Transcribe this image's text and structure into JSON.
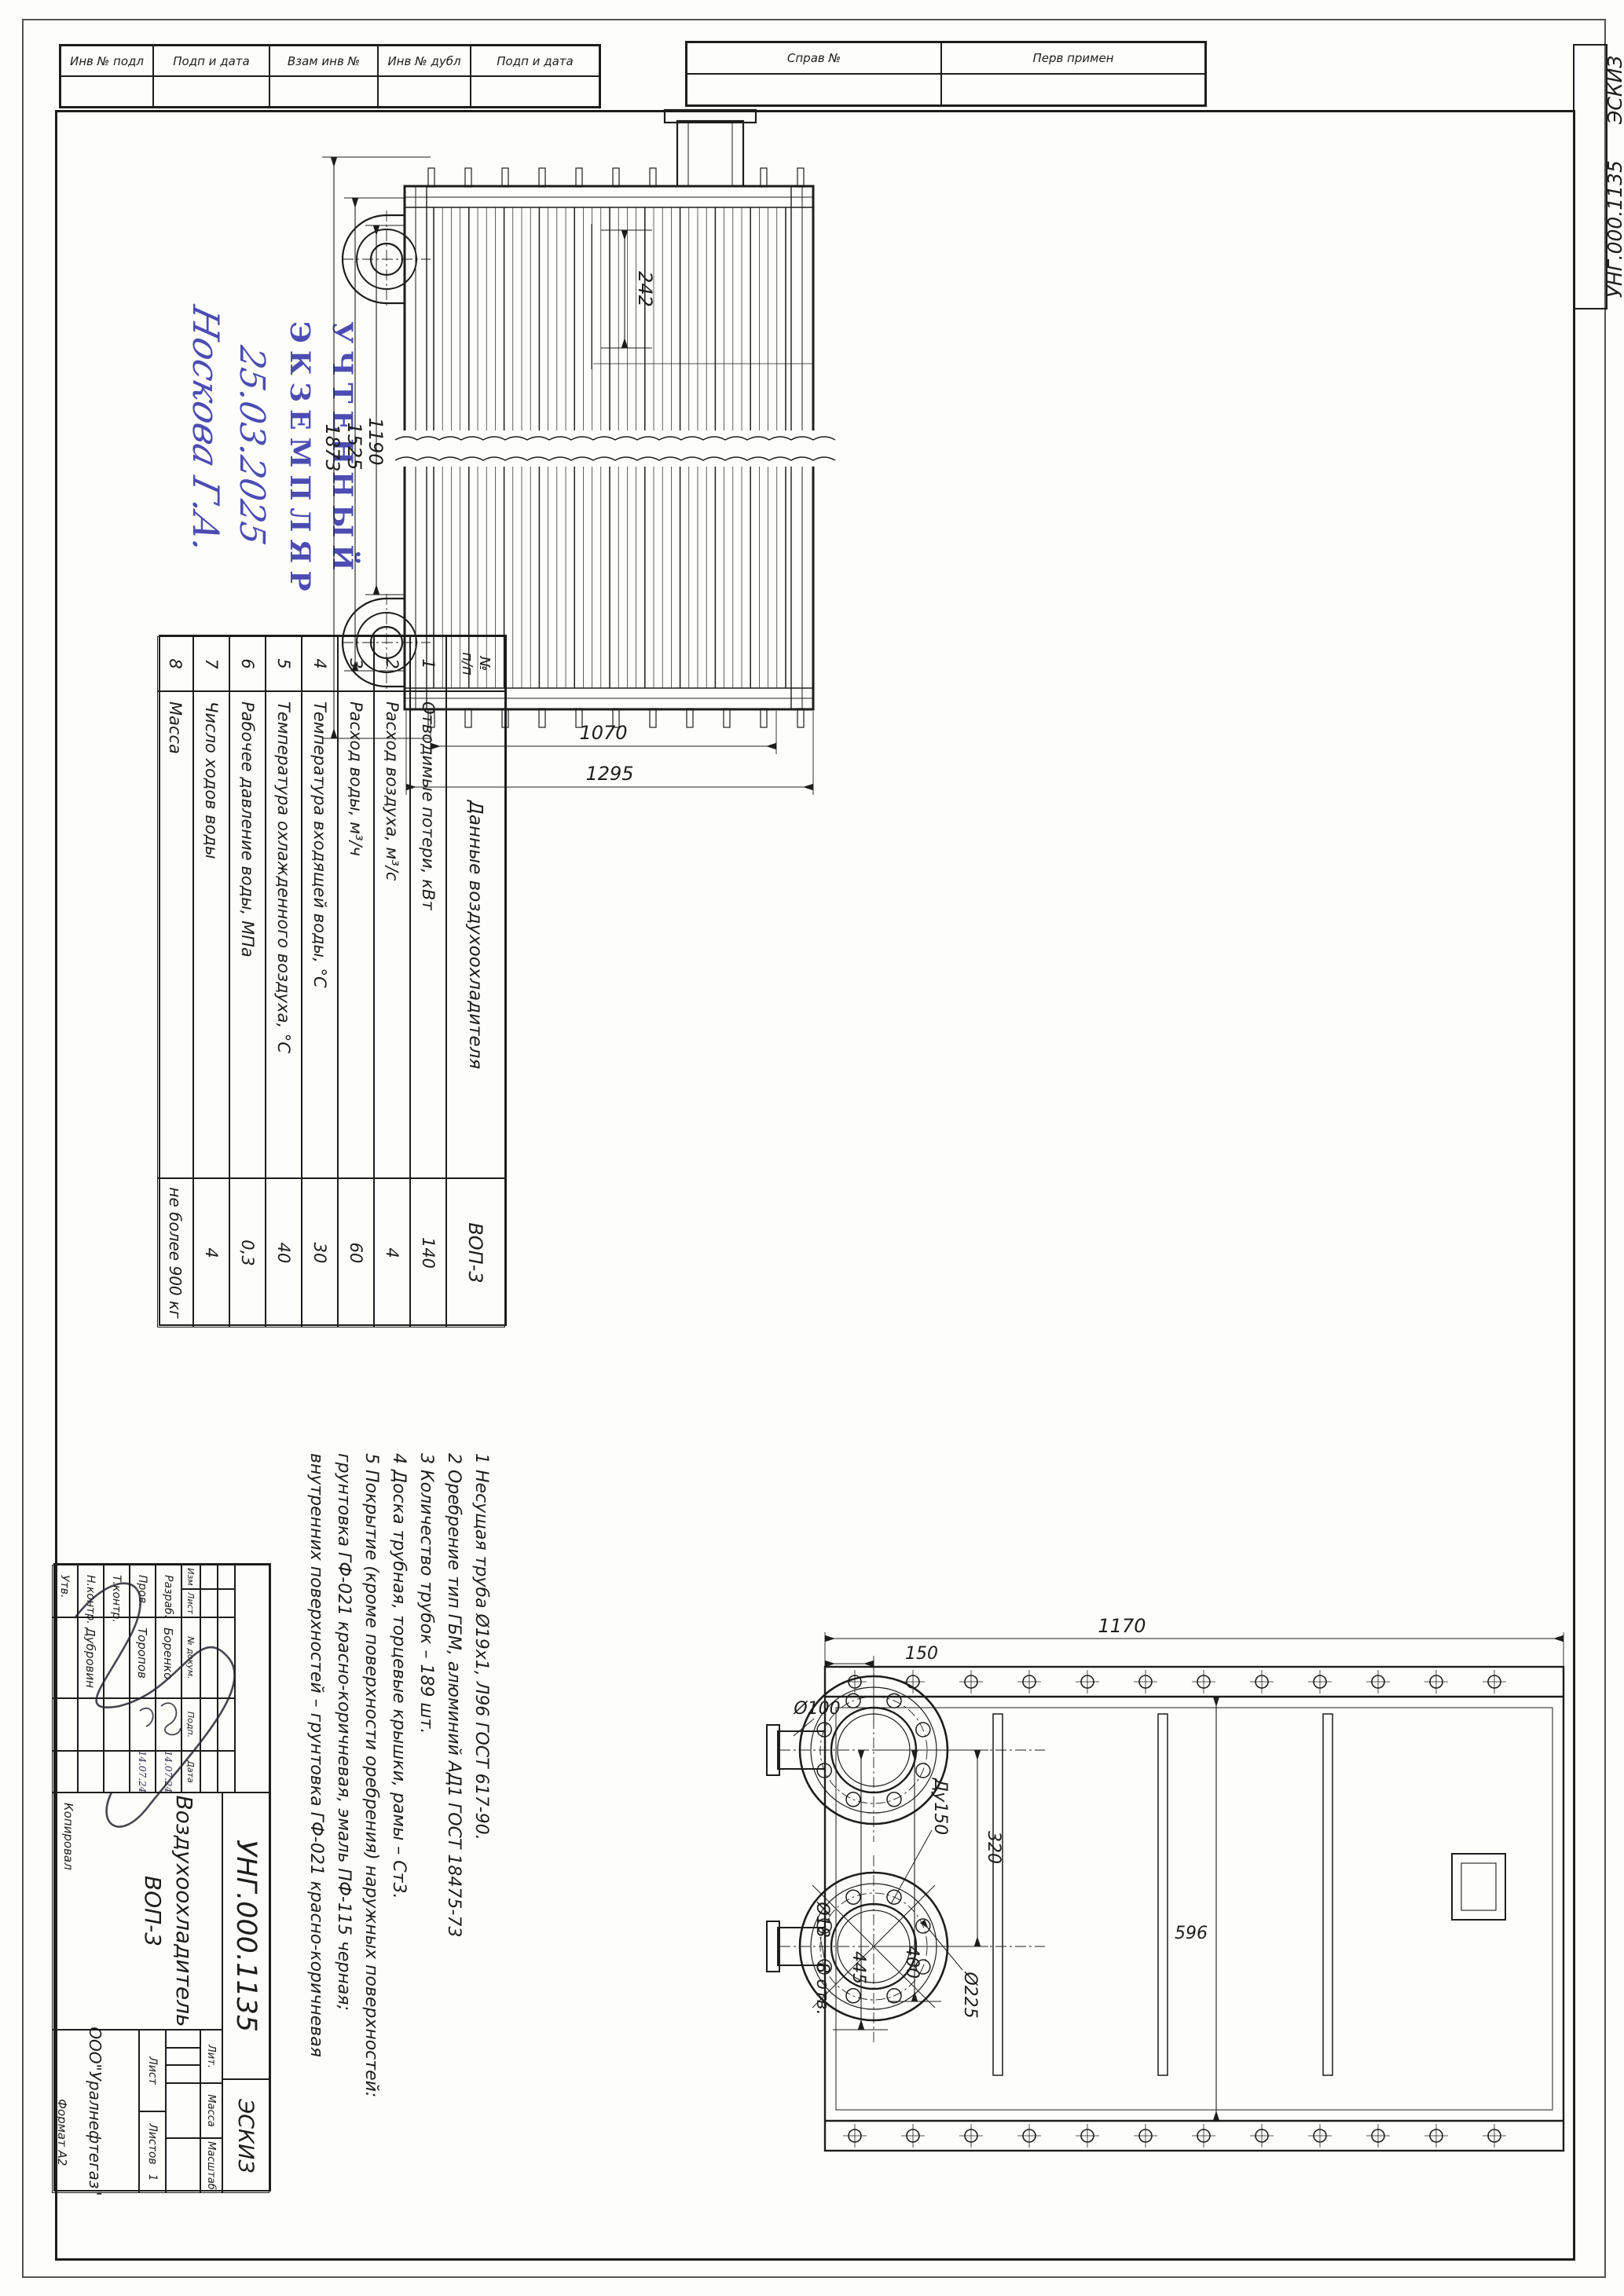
{
  "colors": {
    "ink": "#1d1d1b",
    "stamp_blue": "#3f3fae",
    "paper": "#fdfdfa"
  },
  "top_strips": {
    "left": [
      "Инв № подл",
      "Подп и дата",
      "Взам инв №",
      "Инв № дубл",
      "Подп и дата"
    ],
    "right": [
      "Справ №",
      "Перв примен"
    ]
  },
  "corner": {
    "code": "УНГ.000.1135",
    "type": "ЭСКИЗ"
  },
  "stamp": {
    "line1": "УЧТЕННЫЙ",
    "line2": "ЭКЗЕМПЛЯР",
    "date": "25.03.2025",
    "signer": "Носкова Г.А."
  },
  "spec_table": {
    "col_num_1": "№",
    "col_num_2": "п/п",
    "col_name": "Данные воздухоохладителя",
    "col_value": "ВОП-3",
    "rows": [
      {
        "n": "1",
        "name": "Отводимые потери, кВт",
        "value": "140"
      },
      {
        "n": "2",
        "name": "Расход воздуха, м³/с",
        "value": "4"
      },
      {
        "n": "3",
        "name": "Расход воды, м³/ч",
        "value": "60"
      },
      {
        "n": "4",
        "name": "Температура входящей воды, °С",
        "value": "30"
      },
      {
        "n": "5",
        "name": "Температура охлажденного воздуха, °С",
        "value": "40"
      },
      {
        "n": "6",
        "name": "Рабочее давление воды, МПа",
        "value": "0,3"
      },
      {
        "n": "7",
        "name": "Число ходов воды",
        "value": "4"
      },
      {
        "n": "8",
        "name": "Масса",
        "value": "не более 900 кг"
      }
    ]
  },
  "notes": [
    "1 Несущая труба Ø19х1,  Л96 ГОСТ 617-90.",
    "2 Оребрение тип ГБМ,  алюминий АД1 ГОСТ 18475-73",
    "3 Количество трубок – 189 шт.",
    "4 Доска трубная, торцевые крышки, рамы – Ст3.",
    "5 Покрытие (кроме поверхности оребрения) наружных поверхностей:",
    "грунтовка  ГФ-021  красно-коричневая,  эмаль  ПФ-115  черная;",
    "внутренних поверхностей – грунтовка ГФ-021 красно-коричневая"
  ],
  "main_view": {
    "dim_242": "242",
    "dim_1873": "1873",
    "dim_1525": "1525",
    "dim_1190": "1190",
    "dim_1070": "1070",
    "dim_1295": "1295"
  },
  "bottom_view": {
    "dim_1170": "1170",
    "dim_150": "150",
    "dim_100": "Ø100",
    "dim_445": "445",
    "dim_400": "400",
    "dim_320": "320",
    "dim_596": "596",
    "dim_225": "Ø225",
    "dim_18": "Ø18",
    "dim_8otv": "8 отв.",
    "dim_du150": "Ду150"
  },
  "title_block": {
    "designation": "УНГ.000.1135",
    "doc_type": "ЭСКИЗ",
    "name_line1": "Воздухоохладитель",
    "name_line2": "ВОП-3",
    "company": "ООО\"Уралнефтегаз\"",
    "cols": [
      "Изм",
      "Лист",
      "№ докум.",
      "Подп.",
      "Дата"
    ],
    "people": [
      {
        "role": "Разраб.",
        "name": "Боренко",
        "date": "14.07.24"
      },
      {
        "role": "Пров.",
        "name": "Торопов",
        "date": "14.07.24"
      },
      {
        "role": "Т.контр.",
        "name": "",
        "date": ""
      },
      {
        "role": "Н.контр.",
        "name": "Дубровин",
        "date": ""
      },
      {
        "role": "Утв.",
        "name": "",
        "date": ""
      }
    ],
    "lit": "Лит.",
    "mass": "Масса",
    "scale": "Масштаб",
    "sheet": "Лист",
    "sheets": "Листов",
    "sheets_value": "1"
  },
  "margins": {
    "copied": "Копировал",
    "format": "Формат  А2"
  }
}
